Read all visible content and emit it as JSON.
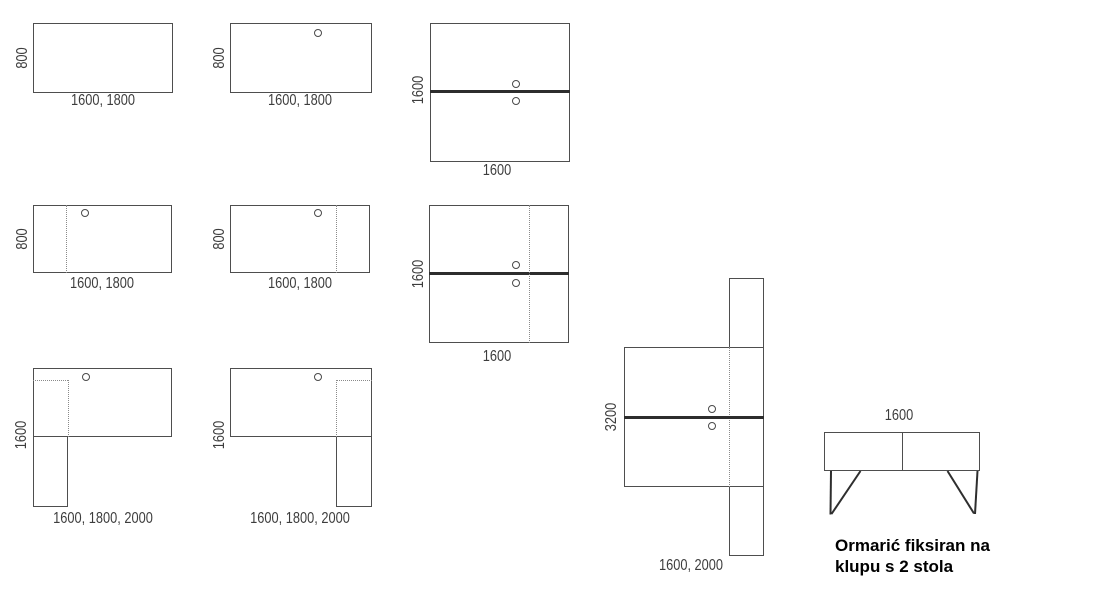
{
  "diagrams": {
    "desk_1": {
      "depth": "800",
      "widths": "1600, 1800"
    },
    "desk_2": {
      "depth": "800",
      "widths": "1600, 1800"
    },
    "bench_1": {
      "depth": "1600",
      "widths": "1600"
    },
    "desk_3": {
      "depth": "800",
      "widths": "1600, 1800"
    },
    "desk_4": {
      "depth": "800",
      "widths": "1600, 1800"
    },
    "bench_2": {
      "depth": "1600",
      "widths": "1600"
    },
    "l_desk_1": {
      "depth": "1600",
      "widths": "1600, 1800, 2000"
    },
    "l_desk_2": {
      "depth": "1600",
      "widths": "1600, 1800, 2000"
    },
    "double_bench": {
      "depth": "3200",
      "widths": "1600, 2000"
    },
    "cabinet_bench": {
      "width": "1600",
      "caption": [
        "Ormarić fiksiran na",
        "klupu s 2 stola"
      ]
    }
  }
}
